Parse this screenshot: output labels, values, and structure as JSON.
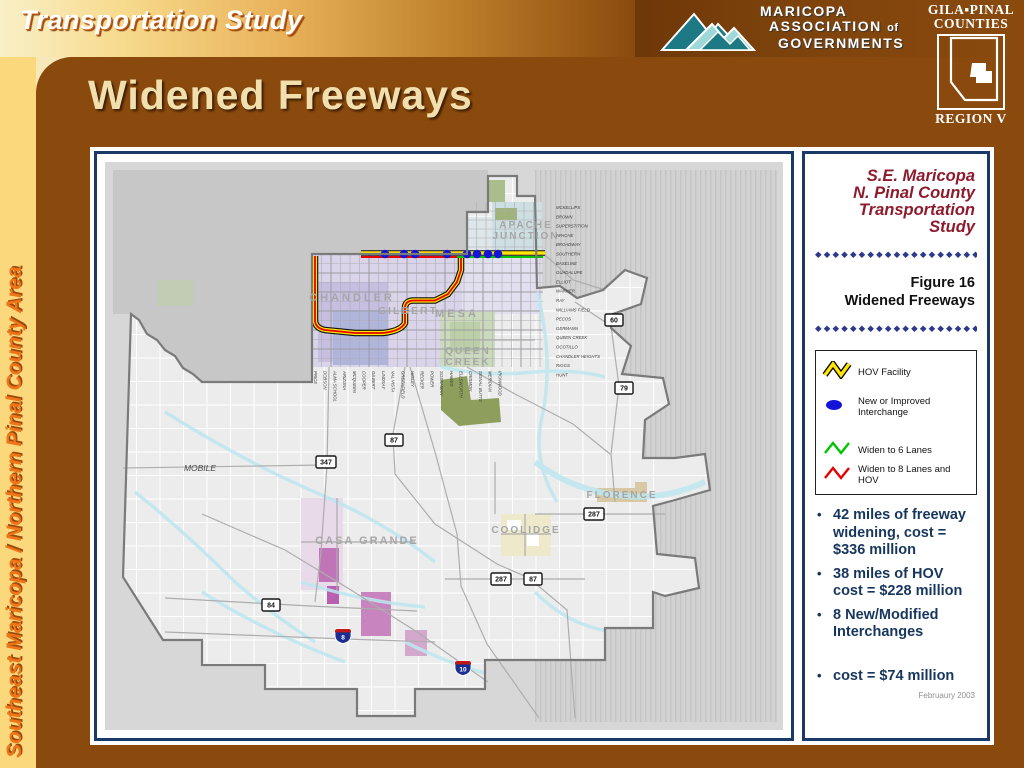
{
  "header": {
    "eyebrow": "Transportation Study",
    "title": "Widened Freeways",
    "mag_logo": {
      "line1": "MARICOPA",
      "line2": "ASSOCIATION",
      "line2b": "of",
      "line3": "GOVERNMENTS"
    },
    "gila_logo": {
      "line1": "GILA▪PINAL",
      "line2": "COUNTIES",
      "region": "REGION V"
    }
  },
  "sidebar": {
    "vertical_label": "Southeast Maricopa / Northern Pinal County Area"
  },
  "panel": {
    "study_title_lines": {
      "l1": "S.E. Maricopa",
      "l2": "N. Pinal County",
      "l3": "Transportation",
      "l4": "Study"
    },
    "diamond_row": "◆◆◆◆◆◆◆◆◆◆◆◆◆◆◆◆◆◆◆◆",
    "figure_label": "Figure 16",
    "figure_title": "Widened Freeways",
    "legend": {
      "hov_label": "HOV Facility",
      "interchange_label": "New or Improved Interchange",
      "six_label": "Widen to 6 Lanes",
      "eight_label": "Widen to 8 Lanes and HOV",
      "hov_color": "#FFE500",
      "interchange_color": "#1414D8",
      "six_color": "#00C400",
      "eight_color": "#E80000"
    },
    "bullets": [
      "42 miles of freeway widening, cost = $336 million",
      "38 miles of HOV cost = $228 million",
      "8 New/Modified Interchanges",
      "cost = $74 million"
    ],
    "date": "Februaury 2003"
  },
  "map": {
    "cities": {
      "apache1": "APACHE",
      "apache2": "JUNCTION",
      "chandler": "CHANDLER",
      "gilbert": "GILBERT",
      "mesa": "MESA",
      "queen1": "QUEEN",
      "queen2": "CREEK",
      "mobile": "MOBILE",
      "casa_grande": "CASA GRANDE",
      "coolidge": "COOLIDGE",
      "florence": "FLORENCE"
    },
    "ew_streets": [
      "MCKELLIPS",
      "BROWN",
      "SUPERSTITION",
      "APACHE",
      "BROADWAY",
      "SOUTHERN",
      "BASELINE",
      "GUADALUPE",
      "ELLIOT",
      "WARNER",
      "RAY",
      "WILLIAMS FIELD",
      "PECOS",
      "GERMANN",
      "QUEEN CREEK",
      "OCOTILLO",
      "CHANDLER HEIGHTS",
      "RIGGS",
      "HUNT"
    ],
    "ns_streets": [
      "PRICE",
      "DOBSON",
      "ALMA SCHOOL",
      "ARIZONA",
      "MCQUEEN",
      "COOPER",
      "GILBERT",
      "LINDSAY",
      "VAL VISTA",
      "GREENFIELD",
      "HIGLEY",
      "RECKER",
      "POWER",
      "SOSSAMAN",
      "HAWES",
      "ELLSWORTH",
      "CRISMON",
      "SIGNAL BUTTE",
      "MERIDIAN",
      "IRONWOOD"
    ],
    "route_shields": [
      "60",
      "79",
      "87",
      "347",
      "287",
      "287",
      "87",
      "84"
    ],
    "interstate_shields": [
      "8",
      "10"
    ]
  }
}
